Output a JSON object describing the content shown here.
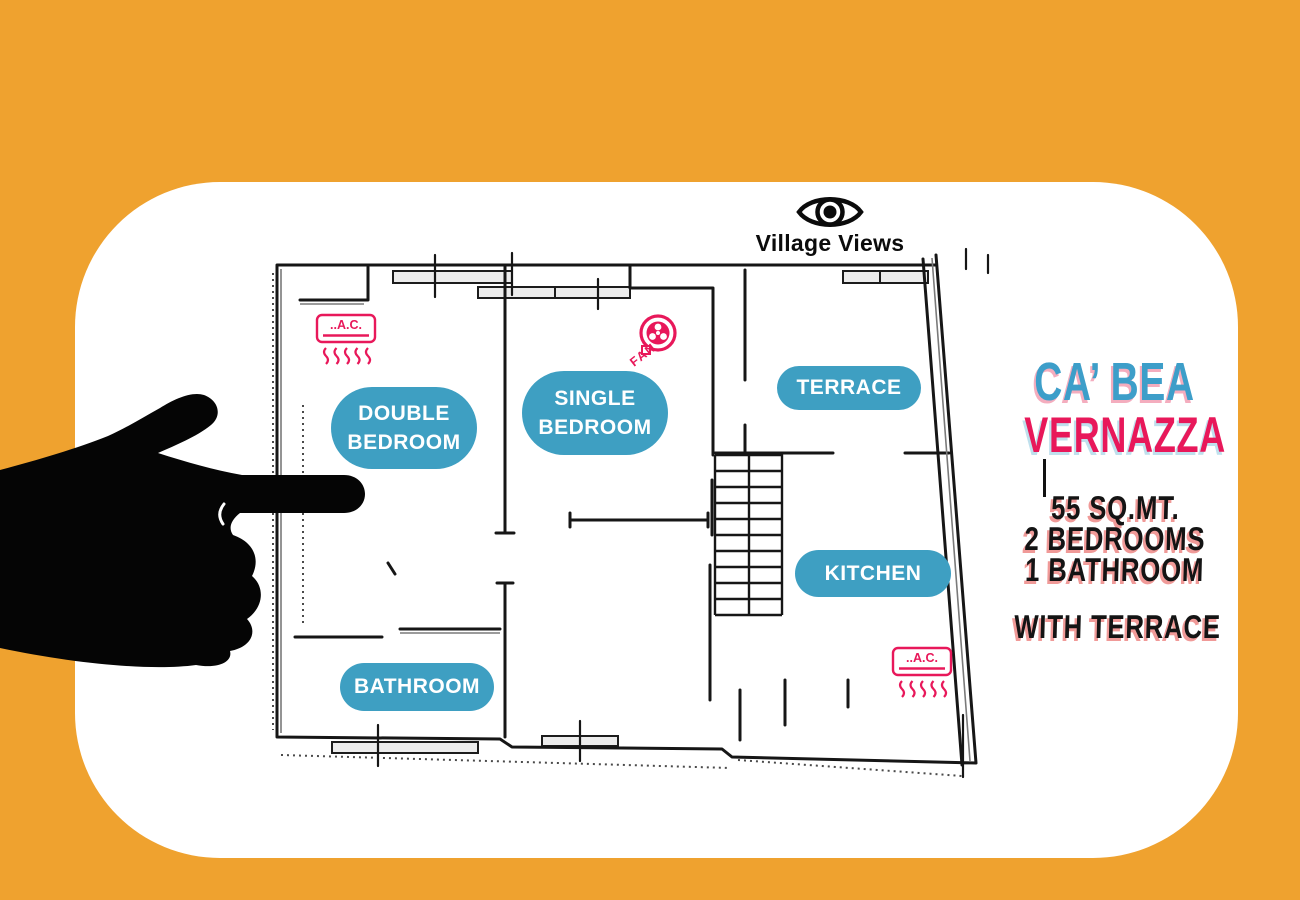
{
  "colors": {
    "background_orange": "#EFA22F",
    "card_white": "#FFFFFF",
    "badge_teal": "#3E9FC2",
    "accent_pink": "#E8185A",
    "title_blue": "#3D9EC9",
    "ink_black": "#141414"
  },
  "logo": {
    "name": "Village Views",
    "icon": "eye-icon"
  },
  "plan": {
    "rooms": {
      "double_bedroom": {
        "line1": "DOUBLE",
        "line2": "BEDROOM"
      },
      "single_bedroom": {
        "line1": "SINGLE",
        "line2": "BEDROOM"
      },
      "terrace": {
        "label": "TERRACE"
      },
      "kitchen": {
        "label": "KITCHEN"
      },
      "bathroom": {
        "label": "BATHROOM"
      }
    },
    "equipment": {
      "ac_label": "..A.C.",
      "fan_label": "FAN"
    }
  },
  "listing": {
    "title_line1": "CA’ BEA",
    "title_line2": "VERNAZZA",
    "specs": [
      "55 SQ.MT.",
      "2 BEDROOMS",
      "1 BATHROOM"
    ],
    "feature": "WITH TERRACE"
  }
}
